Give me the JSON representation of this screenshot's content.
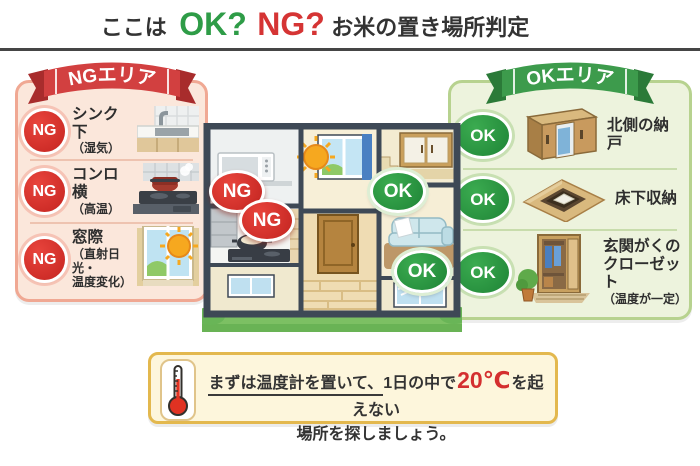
{
  "title": {
    "part1": "ここは",
    "ok": "OK?",
    "ng": "NG?",
    "part2": "お米の置き場所判定"
  },
  "ng_panel": {
    "ribbon": "NGエリア",
    "items": [
      {
        "badge": "NG",
        "label": "シンク下",
        "sub": "（湿気）",
        "icon": "kitchen-sink"
      },
      {
        "badge": "NG",
        "label": "コンロ横",
        "sub": "（高温）",
        "icon": "gas-stove"
      },
      {
        "badge": "NG",
        "label": "窓際",
        "sub": "（直射日光・\n温度変化）",
        "icon": "sunny-window"
      }
    ]
  },
  "ok_panel": {
    "ribbon": "OKエリア",
    "items": [
      {
        "badge": "OK",
        "label": "北側の納戸",
        "sub": "",
        "icon": "storage-cabinet"
      },
      {
        "badge": "OK",
        "label": "床下収納",
        "sub": "",
        "icon": "underfloor-storage"
      },
      {
        "badge": "OK",
        "label": "玄関がくの\nクローゼット",
        "sub": "（温度が一定）",
        "icon": "entrance-closet"
      }
    ]
  },
  "house_badges": [
    {
      "text": "NG"
    },
    {
      "text": "NG"
    },
    {
      "text": "OK"
    },
    {
      "text": "OK"
    }
  ],
  "note": {
    "underlined": "まずは温度計を置いて、",
    "mid": "1日の中で",
    "temp": "20℃",
    "end": "を起えない",
    "line2": "場所を探しましょう。"
  },
  "colors": {
    "ok_green": "#2e9c47",
    "ng_red": "#d53434",
    "ng_panel_bg": "#fbe7db",
    "ng_panel_border": "#f0a893",
    "ng_ribbon": "#d24040",
    "ok_panel_bg": "#edf3dd",
    "ok_panel_border": "#b7d28f",
    "ok_ribbon": "#3d9b4c",
    "note_bg": "#fdf6dc",
    "note_border": "#e3b84e",
    "temp_red": "#d42f2f",
    "house_wall": "#3e4956",
    "grass_green": "#7cc063"
  }
}
